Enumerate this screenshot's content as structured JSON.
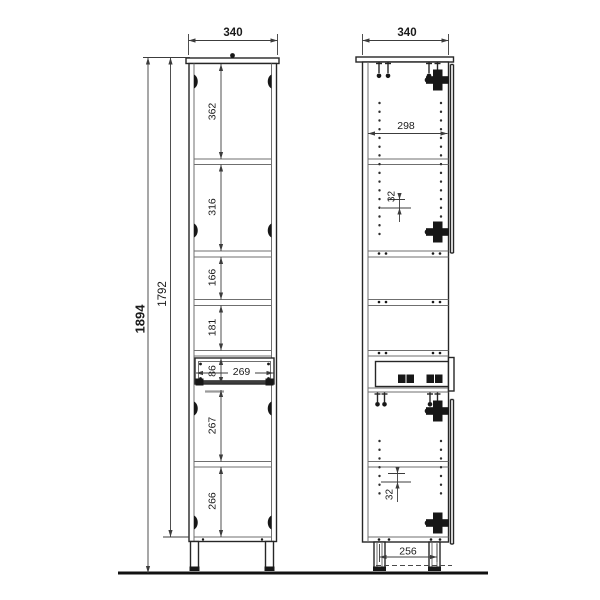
{
  "drawing": {
    "front_view": {
      "width": "340",
      "overall_height": "1894",
      "carcass_height": "1792",
      "compartments_top_to_bottom": [
        "362",
        "316",
        "166",
        "181"
      ],
      "drawer_front_height": "86",
      "drawer_front_width": "269",
      "lower_compartments": [
        "267",
        "266"
      ]
    },
    "side_view": {
      "depth": "340",
      "internal_depth": "298",
      "shelf_hole_pitch_upper": "32",
      "shelf_hole_pitch_lower": "32",
      "foot_spacing": "256"
    }
  }
}
